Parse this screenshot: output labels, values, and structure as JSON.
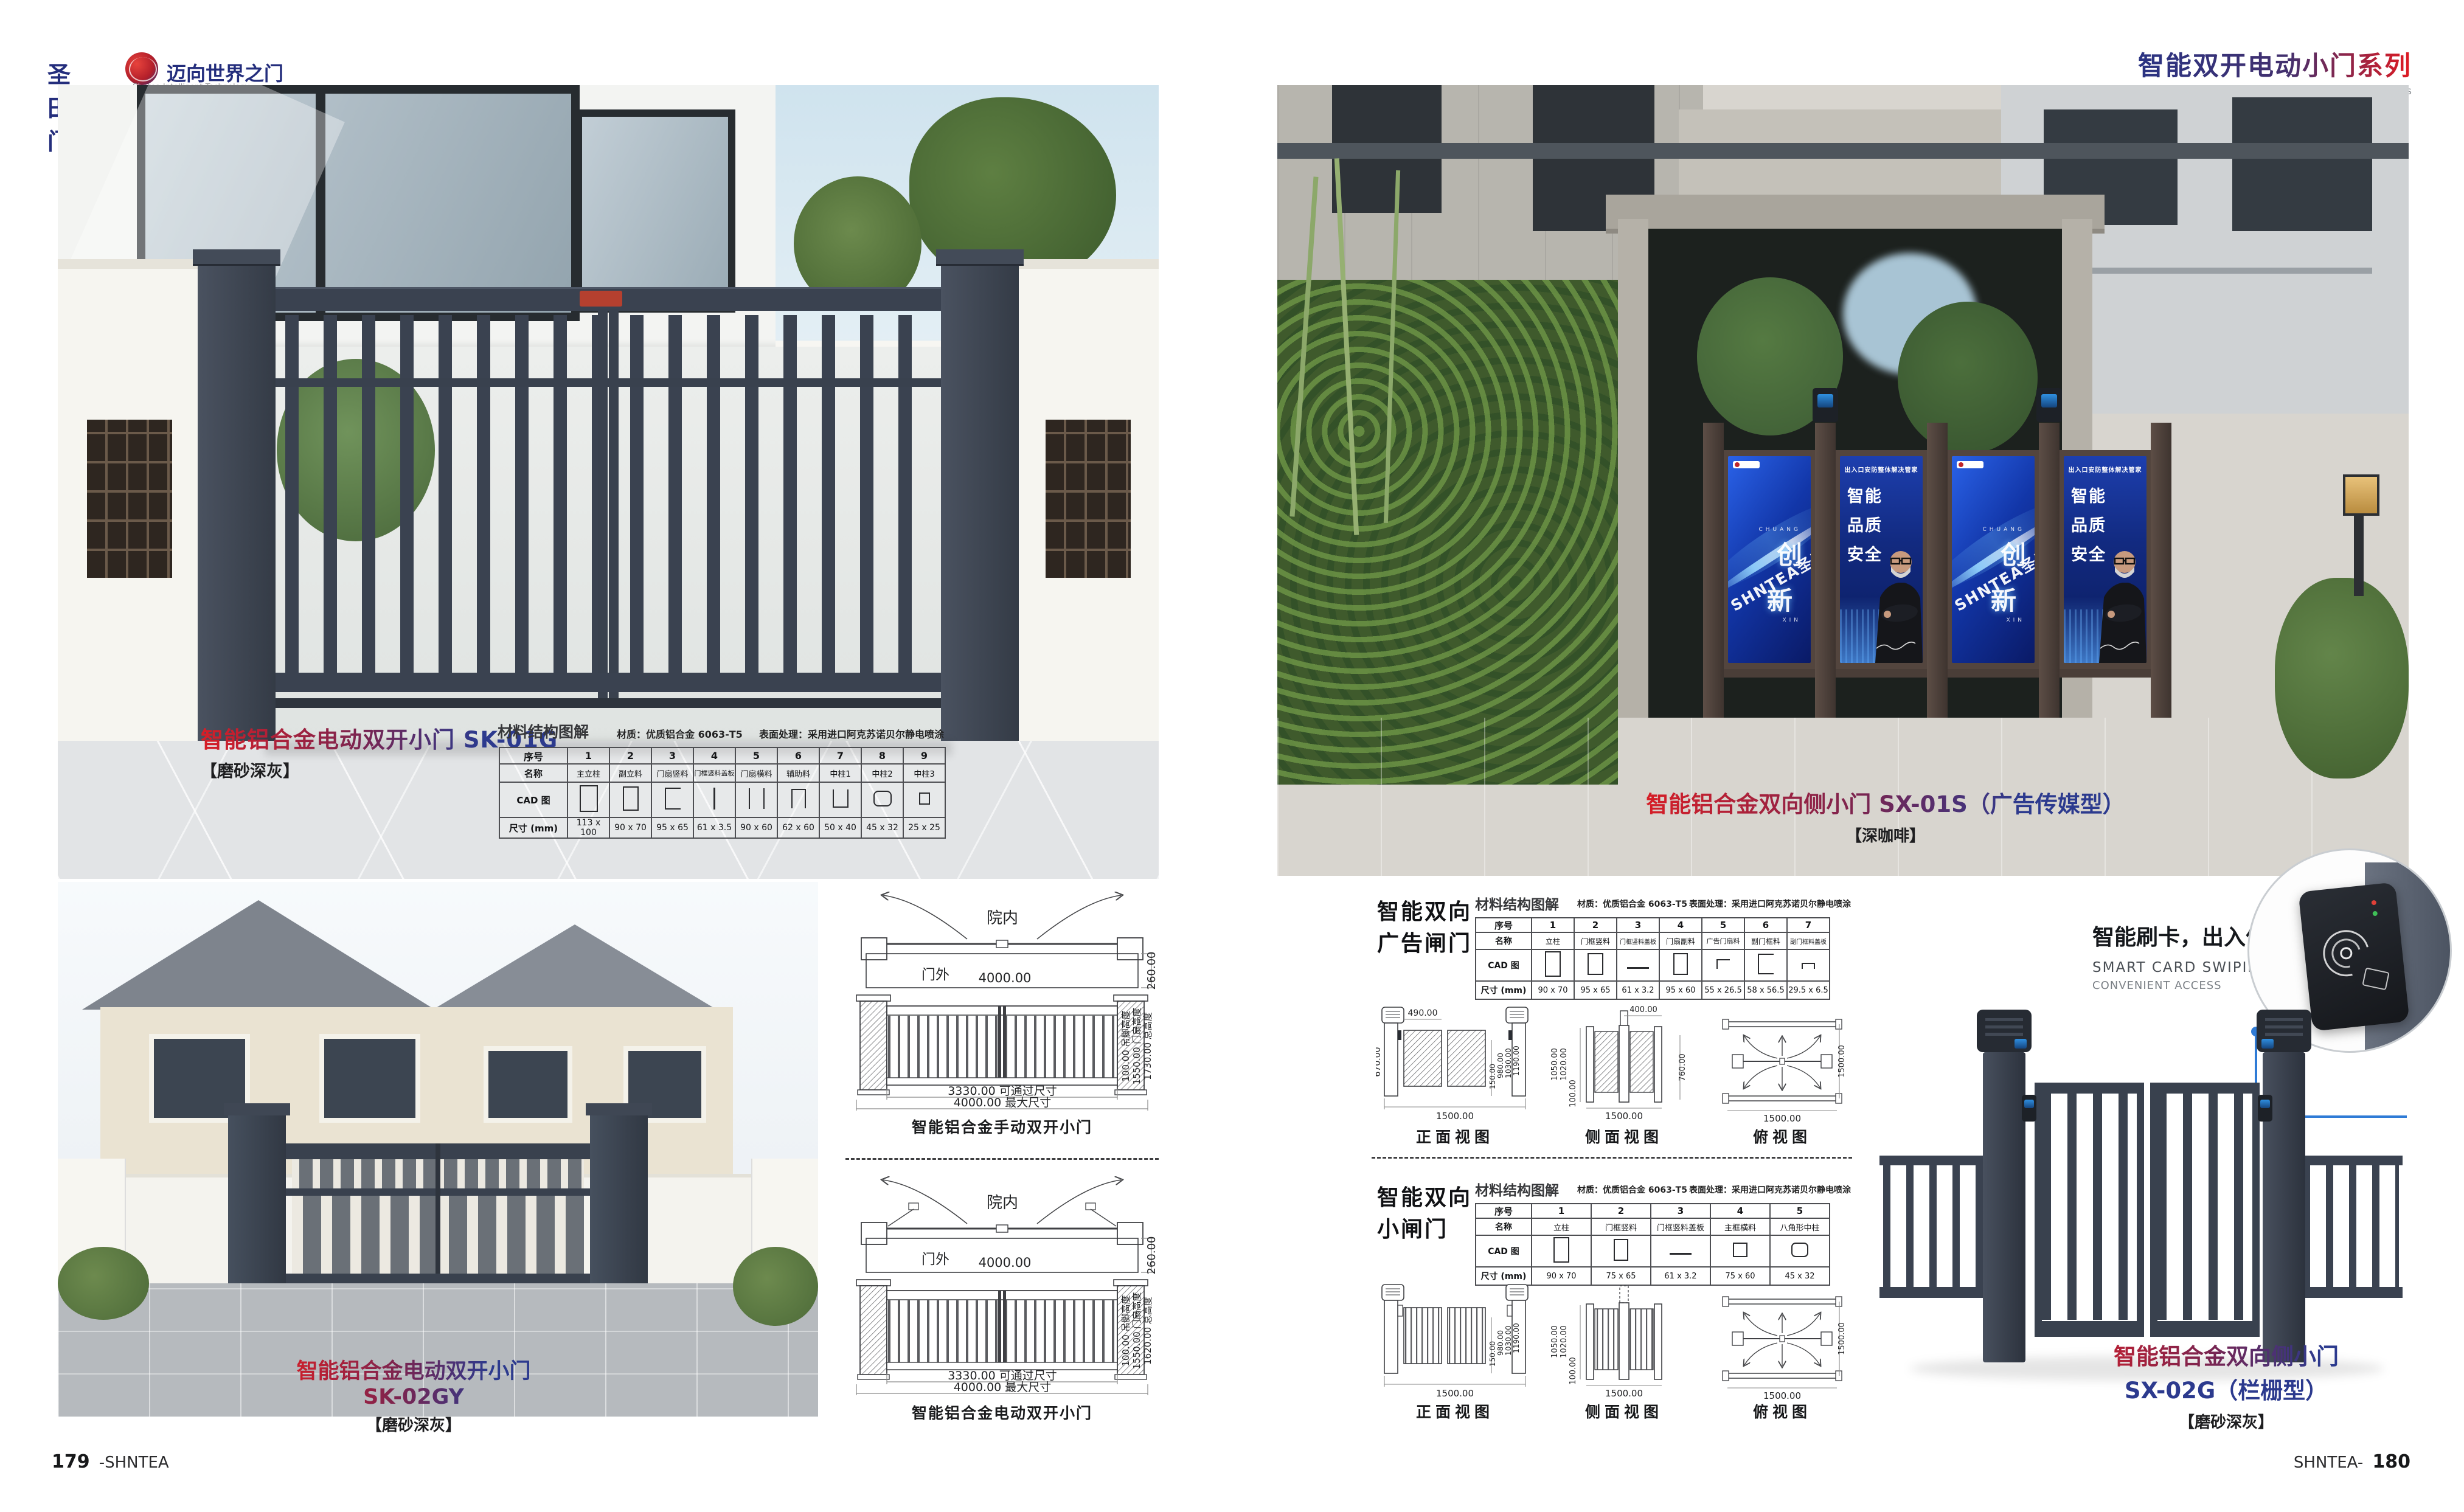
{
  "header": {
    "logo_cn": "圣田门",
    "logo_slogan": "迈向世界之门",
    "logo_en": "Shntea Intelligent Technology",
    "series_title": "智能双开电动小门系列",
    "series_subtitle": "Intelligent double-opening electric small door series"
  },
  "footer": {
    "page_left": "179",
    "brand_left": "-SHNTEA",
    "brand_right": "SHNTEA-",
    "page_right": "180"
  },
  "products": {
    "sk01g": {
      "title": "智能铝合金电动双开小门 SK-01G",
      "finish": "【磨砂深灰】"
    },
    "sk02gy": {
      "title": "智能铝合金电动双开小门 SK-02GY",
      "finish": "【磨砂深灰】"
    },
    "sx01s": {
      "title": "智能铝合金双向侧小门 SX-01S（广告传媒型）",
      "finish": "【深咖啡】"
    },
    "sx02g": {
      "title1": "智能铝合金双向侧小门",
      "title2": "SX-02G（栏栅型）",
      "finish": "【磨砂深灰】"
    }
  },
  "table_sk01g": {
    "heading": "材料结构图解",
    "material": "材质：优质铝合金 6063-T5",
    "surface": "表面处理：采用进口阿克苏诺贝尔静电喷涂",
    "row_no": "序号",
    "row_name": "名称",
    "row_cad": "CAD 图",
    "row_size": "尺寸 (mm)",
    "nos": [
      "1",
      "2",
      "3",
      "4",
      "5",
      "6",
      "7",
      "8",
      "9"
    ],
    "names": [
      "主立柱",
      "副立料",
      "门扇竖料",
      "门框竖料盖板",
      "门扇横料",
      "辅助料",
      "中柱1",
      "中柱2",
      "中柱3"
    ],
    "sizes": [
      "113 x 100",
      "90 x 70",
      "95 x 65",
      "61 x 3.5",
      "90 x 60",
      "62 x 60",
      "50 x 40",
      "45 x 32",
      "25 x 25"
    ]
  },
  "cad_left": {
    "set1": {
      "inside": "院内",
      "outside": "门外",
      "width": "4000.00",
      "depth": "260.00",
      "pass": "3330.00  可通过尺寸",
      "max": "4000.00  最大尺寸",
      "v1": "100.00 吊脚高度",
      "v2": "1550.00 门扇高度",
      "v3": "1730.00 总高度",
      "caption": "智能铝合金手动双开小门"
    },
    "set2": {
      "inside": "院内",
      "outside": "门外",
      "width": "4000.00",
      "depth": "260.00",
      "pass": "3330.00  可通过尺寸",
      "max": "4000.00  最大尺寸",
      "v1": "100.00 吊脚高度",
      "v2": "1550.00 门扇高度",
      "v3": "1620.00 总高度",
      "caption": "智能铝合金电动双开小门"
    }
  },
  "section_ad": {
    "h1": "智能双向",
    "h2": "广告闸门",
    "table": {
      "heading": "材料结构图解",
      "material": "材质：优质铝合金 6063-T5",
      "surface": "表面处理：采用进口阿克苏诺贝尔静电喷涂",
      "row_no": "序号",
      "row_name": "名称",
      "row_cad": "CAD 图",
      "row_size": "尺寸 (mm)",
      "nos": [
        "1",
        "2",
        "3",
        "4",
        "5",
        "6",
        "7"
      ],
      "names": [
        "立柱",
        "门框竖料",
        "门框竖料盖板",
        "门扇副料",
        "广告门扇料",
        "副门框料",
        "副门框料盖板"
      ],
      "sizes": [
        "90 x 70",
        "95 x 65",
        "61 x 3.2",
        "95 x 60",
        "55 x 26.5",
        "58 x 56.5",
        "29.5 x 6.5"
      ]
    },
    "views": {
      "front_label": "正面视图",
      "side_label": "侧面视图",
      "top_label": "俯视图",
      "front": {
        "top": "490.00",
        "left": "670.00",
        "right": [
          "150.00",
          "980.00",
          "1030.00",
          "1190.00"
        ],
        "bottom": "1500.00"
      },
      "side": {
        "top": "400.00",
        "left": [
          "1050.00",
          "1020.00",
          "100.00"
        ],
        "right": "760.00",
        "bottom": "1500.00"
      },
      "top": {
        "right": "1500.00",
        "bottom": "1500.00"
      }
    }
  },
  "section_small": {
    "h1": "智能双向",
    "h2": "小闸门",
    "table": {
      "heading": "材料结构图解",
      "material": "材质：优质铝合金 6063-T5",
      "surface": "表面处理：采用进口阿克苏诺贝尔静电喷涂",
      "row_no": "序号",
      "row_name": "名称",
      "row_cad": "CAD 图",
      "row_size": "尺寸 (mm)",
      "nos": [
        "1",
        "2",
        "3",
        "4",
        "5"
      ],
      "names": [
        "立柱",
        "门框竖料",
        "门框竖料盖板",
        "主框横料",
        "八角形中柱"
      ],
      "sizes": [
        "90 x 70",
        "75 x 65",
        "61 x 3.2",
        "75 x 60",
        "45 x 32"
      ]
    },
    "views": {
      "front_label": "正面视图",
      "side_label": "侧面视图",
      "top_label": "俯视图",
      "front": {
        "right": [
          "150.00",
          "980.00",
          "1030.00",
          "1190.00"
        ],
        "bottom": "1500.00"
      },
      "side": {
        "left": [
          "1050.00",
          "1020.00",
          "100.00"
        ],
        "bottom": "1500.00"
      },
      "top": {
        "right": "1500.00",
        "bottom": "1500.00"
      }
    }
  },
  "smart_card": {
    "title": "智能刷卡，出入便捷",
    "sub1": "SMART CARD SWIPING,",
    "sub2": "CONVENIENT ACCESS"
  },
  "poster_innovate": {
    "en_top": "CHUANG",
    "char1": "创",
    "char2": "新",
    "en_bottom": "XIN",
    "watermark": "SHNTEA圣田"
  },
  "poster_quality": {
    "banner": "出入口安防整体解决管家",
    "w1": "智能",
    "w2": "品质",
    "w3": "安全"
  },
  "colors": {
    "navy": "#2c3a8e",
    "red": "#e01a22",
    "gate_dark_gray": "#3a4250",
    "gate_brown": "#4a3e38",
    "poster_blue": "#16339b"
  }
}
